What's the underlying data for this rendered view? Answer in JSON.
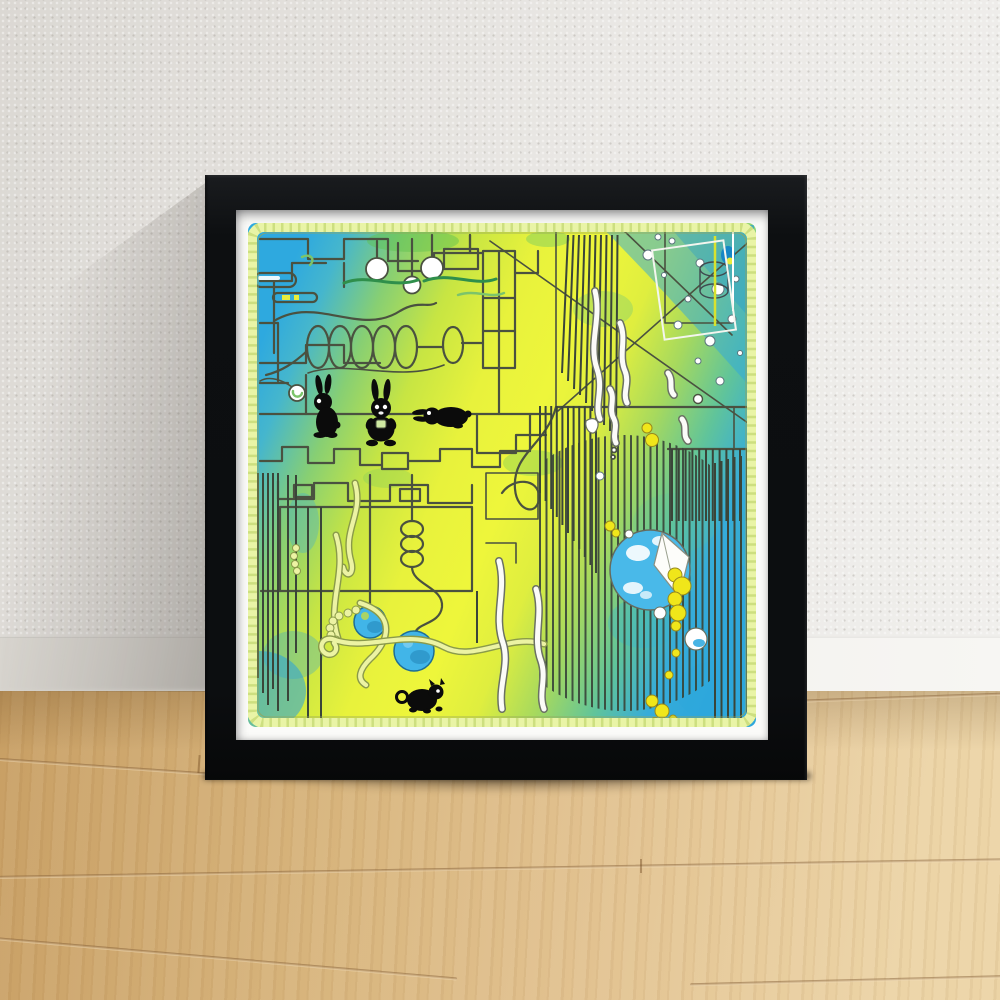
{
  "scene": {
    "description": "Photograph of a black square picture frame leaning against a white textured wall on a light oak wood floor. The framed print is an abstract blue-green-yellow gradient illustration with maze-like line work, three black rabbits, a black cat, hanging white balls, coil springs, blue pendulum circles, a hatched sphere of vertical lines, a moon with a bite-shaped notch and scattered yellow blobs, edged by a pale yellow-green scalloped border.",
    "wall": "white textured plaster",
    "baseboard": "white skirting board",
    "floor": "light oak plank flooring with diagonal seams",
    "lighting": "daylight from the right; soft shadow cast on the wall left of the frame and beneath it on the floor"
  },
  "frame": {
    "style": "black square wooden frame",
    "mat": "white mat border"
  },
  "artwork": {
    "style": "abstract pen-line illustration over a blue-to-yellow-to-blue watercolor gradient",
    "border": "pale yellow-green scalloped ribbon border",
    "figures": [
      "standing black rabbit",
      "sitting black rabbit holding a green cup",
      "lying black rabbit",
      "small black cat",
      "blue moon with white clouds and a bite-shaped notch"
    ],
    "elements": [
      "maze-like stepped lines",
      "hanging white ball lamps",
      "horizontal coil spring with cylinder",
      "light blue capsules",
      "white ball on a string",
      "two blue pendulum circles on strings",
      "vertical coil spring",
      "hatched sphere of vertical lines",
      "fanned vertical line groups",
      "comb of short vertical lines",
      "diagonal construction lines",
      "ladder rectangle",
      "white squiggle ribbons",
      "yellow squiggle ribbons",
      "beaded yellow arcs",
      "scattered yellow blobs",
      "white bubbles in blue corner",
      "cylinder rings",
      "green leaf squiggles",
      "watercolor splotches"
    ],
    "background_gradient": [
      "#2EA9DF",
      "#87CF73",
      "#EEF63B",
      "#A6D95E",
      "#60C49A",
      "#2EA7DC"
    ]
  },
  "palette": {
    "wall": "#E7E5E1",
    "wall-dark": "#D8D5CF",
    "baseboard": "#F2F1EE",
    "floor-1": "#C89F64",
    "floor-2": "#D8B57D",
    "floor-3": "#ECD4A6",
    "seam": "#8A5F33",
    "frame": "#0D0F11",
    "mat": "#FBFBF9",
    "line": "#4A5140",
    "line-soft": "#3A4539",
    "scallop": "#E9F4A6",
    "scallop-dot": "#C8DB79",
    "black": "#0B0B0B",
    "ball-blue": "#41B5E8",
    "ball-blue-dark": "#1E6E95",
    "moon": "#FDFDFA",
    "moon-blue": "#49B9E9",
    "blob": "#F0E61A",
    "blob-edge": "#97891D",
    "ribbon-yellow": "#ECF3A3",
    "ribbon-yellow-edge": "#8A9A4A",
    "ribbon-white": "#FBFBF8",
    "ribbon-white-edge": "#6B7164",
    "leaf": "#2F8F4B",
    "leaf-light": "#7CC46A",
    "capsule": "#CDEBF7",
    "art-blue": "#2EA9DF",
    "art-yellow": "#EEF63B",
    "art-green": "#87CF73",
    "art-teal": "#60C49A"
  }
}
